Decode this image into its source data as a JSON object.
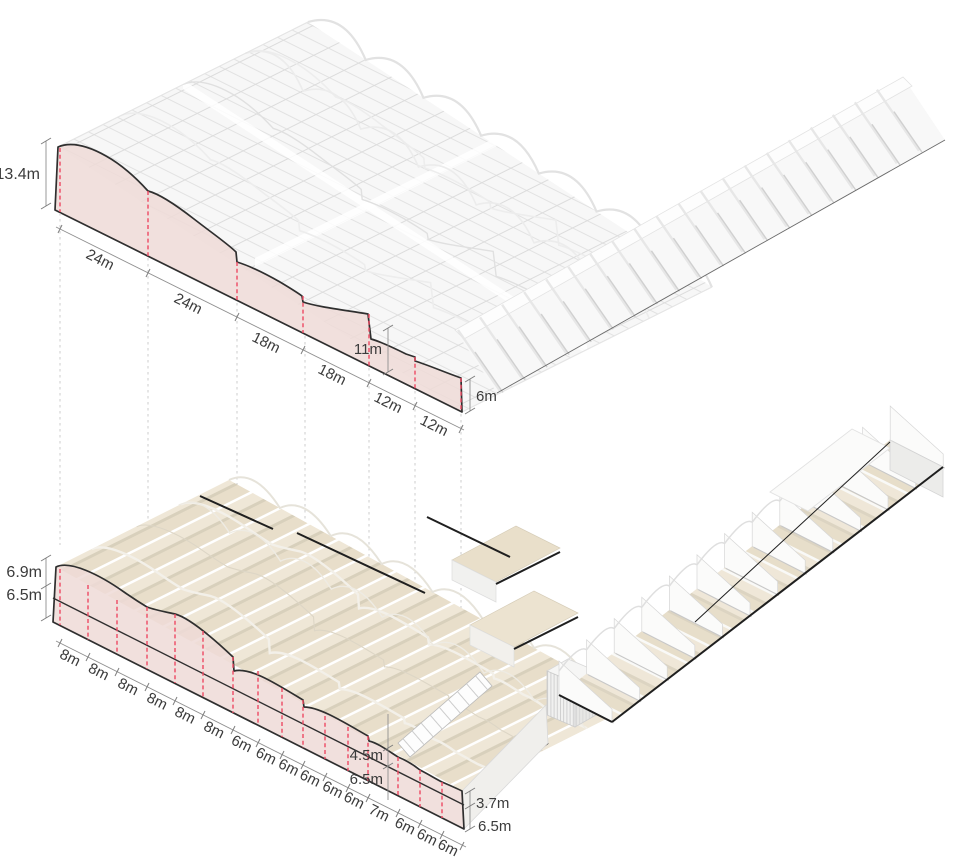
{
  "diagram": {
    "type": "architectural-axonometric-sections",
    "colors": {
      "section_fill": "#eedbd7",
      "section_outline": "#2f2f2f",
      "bay_grid_red": "#ee4a63",
      "projection_dash_grey": "#cdcdcd",
      "dimension_grey": "#8f8f8f",
      "roof_tan": "#e8deca",
      "structure_grey": "#e1e1e1",
      "accent_black": "#1f1f1f",
      "text": "#3b3b3b"
    },
    "top_drawing": {
      "height_left": "13.4m",
      "bay_dims": [
        "24m",
        "24m",
        "18m",
        "18m",
        "12m",
        "12m"
      ],
      "height_step": "11m",
      "height_right": "6m"
    },
    "bottom_drawing": {
      "height_left_upper": "6.9m",
      "height_left_lower": "6.5m",
      "bay_dims": [
        "8m",
        "8m",
        "8m",
        "8m",
        "8m",
        "8m",
        "6m",
        "6m",
        "6m",
        "6m",
        "6m",
        "6m",
        "7m",
        "6m",
        "6m",
        "6m"
      ],
      "height_mid_upper": "4.5m",
      "height_mid_lower": "6.5m",
      "height_right_upper": "3.7m",
      "height_right_lower": "6.5m"
    }
  }
}
